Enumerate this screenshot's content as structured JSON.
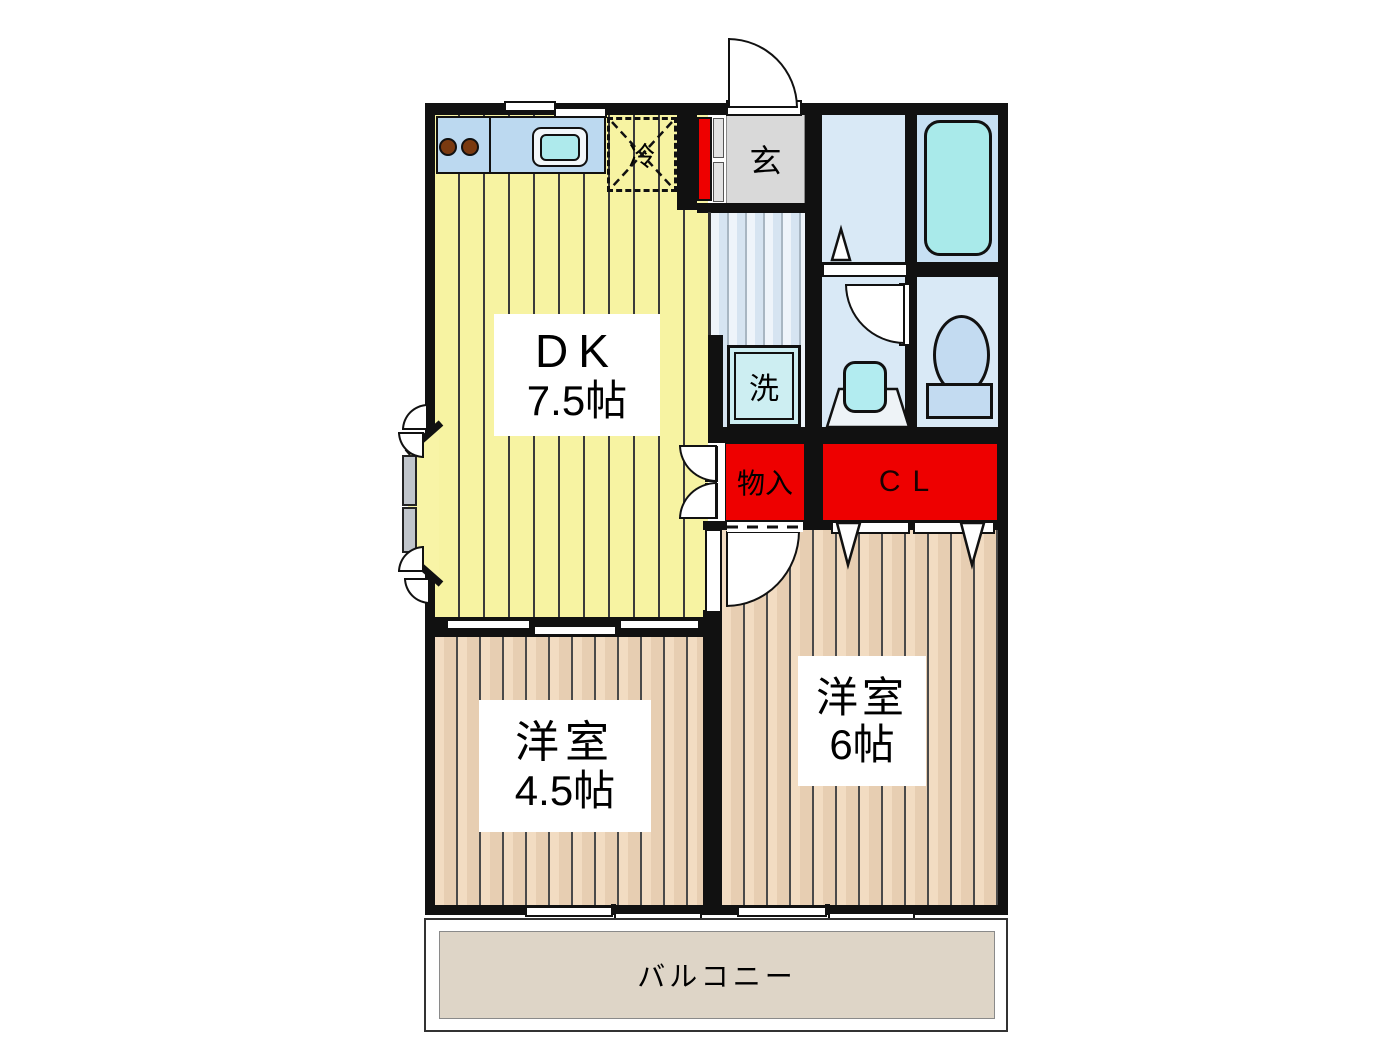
{
  "plan_type": "apartment-floorplan",
  "rooms": {
    "dk": {
      "name": "DK",
      "size": "7.5帖"
    },
    "western_4_5": {
      "name": "洋室",
      "size": "4.5帖"
    },
    "western_6": {
      "name": "洋室",
      "size": "6帖"
    }
  },
  "labels": {
    "entrance": "玄",
    "washer": "洗",
    "refrigerator": "冷",
    "storage": "物入",
    "closet": "CL",
    "balcony": "バルコニー"
  },
  "colors": {
    "wall_black": "#111111",
    "dk_floor_yellow": "#f7f3a2",
    "western_floor_tan": "#eed3b8",
    "hallway_floor_blue": "#dce8f4",
    "entrance_floor_gray": "#d9d9d9",
    "wetroom_floor_blue": "#d9e9f6",
    "tubroom_floor_blue": "#c7e0f3",
    "fixture_cyan": "#aeeaec",
    "kitchen_counter_blue": "#bcd9f0",
    "toilet_fill_blue": "#c3dbf1",
    "storage_red": "#ee0000",
    "balcony_floor_beige": "#ded5c7",
    "burner_brown": "#7a3a10"
  }
}
